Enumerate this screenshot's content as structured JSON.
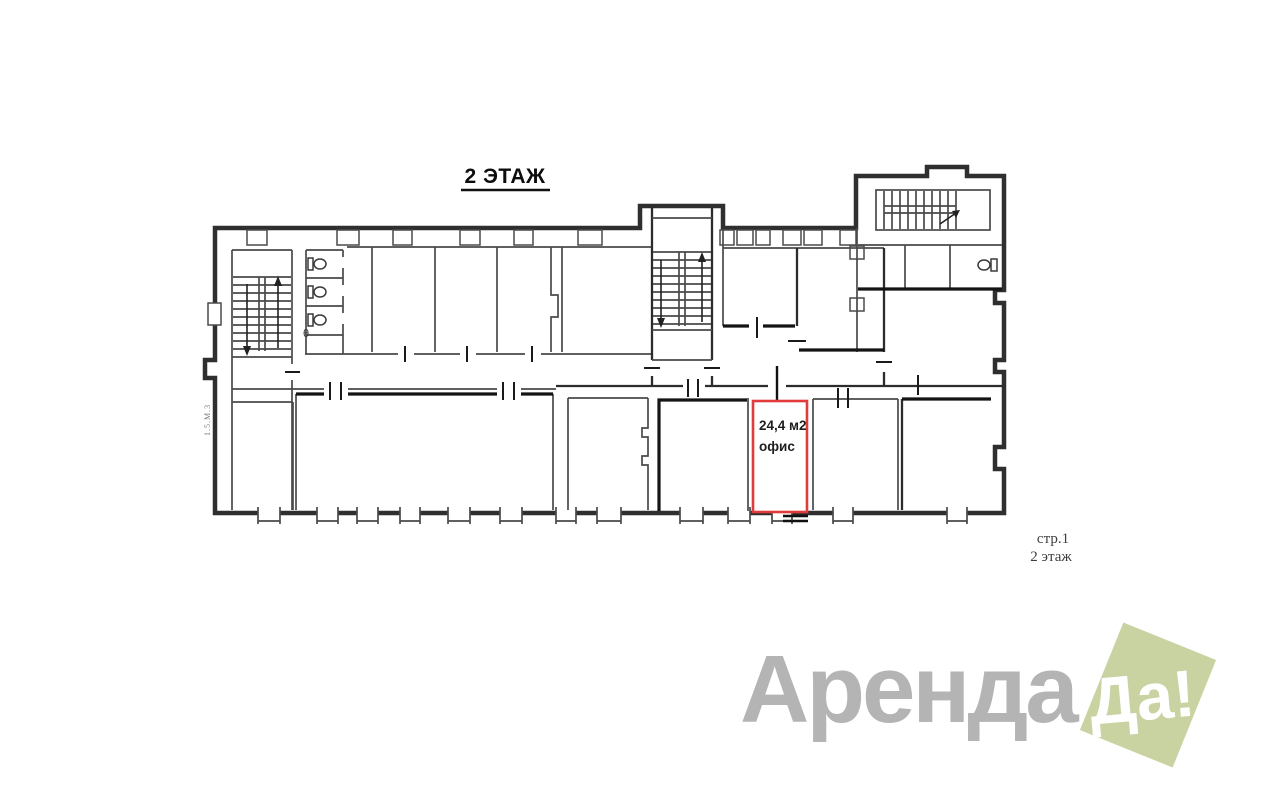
{
  "plan": {
    "title": "2 ЭТАЖ",
    "side_note": "1.5.М.3",
    "theta_label": "θ",
    "highlight": {
      "area": "24,4 м2",
      "type": "офис",
      "border_color": "#e03c3c"
    },
    "page_note": {
      "line1": "стр.1",
      "line2": "2 этаж"
    },
    "ink_color": "#2f2f2f"
  },
  "logo": {
    "brand_gray": "Аренда",
    "brand_accent": "Да!",
    "gray_color": "#b4b4b4",
    "accent_bg_color": "#c9d3a2",
    "accent_text_color": "#ffffff"
  }
}
